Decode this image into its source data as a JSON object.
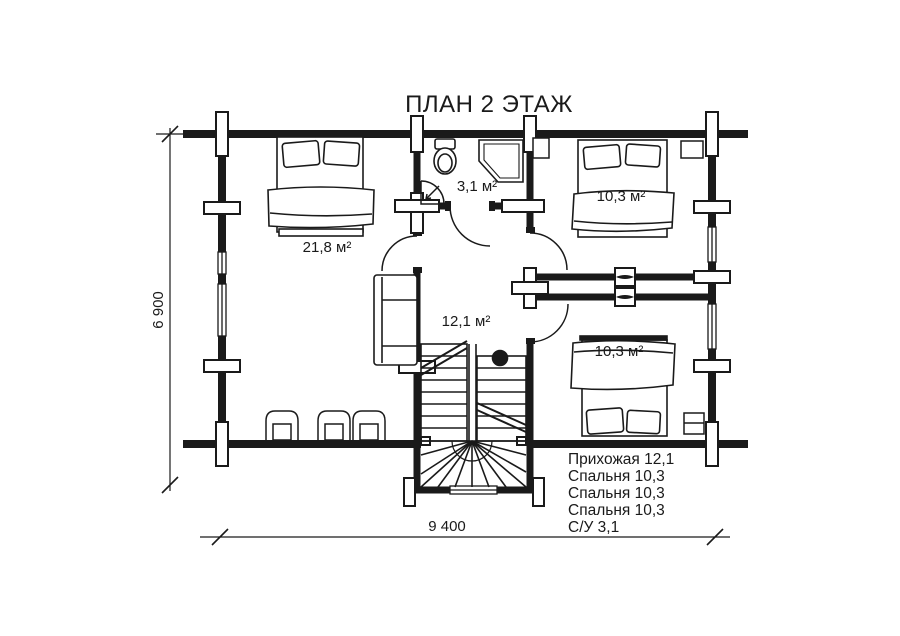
{
  "title": "ПЛАН 2 ЭТАЖ",
  "rooms": {
    "bedroom_left": "21,8 м²",
    "bathroom": "3,1 м²",
    "bedroom_top_right": "10,3 м²",
    "hallway": "12,1 м²",
    "bedroom_bottom_right": "10,3 м²"
  },
  "dimensions": {
    "horizontal": "9 400",
    "vertical": "6 900"
  },
  "legend": [
    "Прихожая 12,1",
    "Спальня 10,3",
    "Спальня 10,3",
    "Спальня 10,3",
    "С/У 3,1"
  ],
  "colors": {
    "line": "#1a1a1a",
    "background": "#ffffff"
  }
}
